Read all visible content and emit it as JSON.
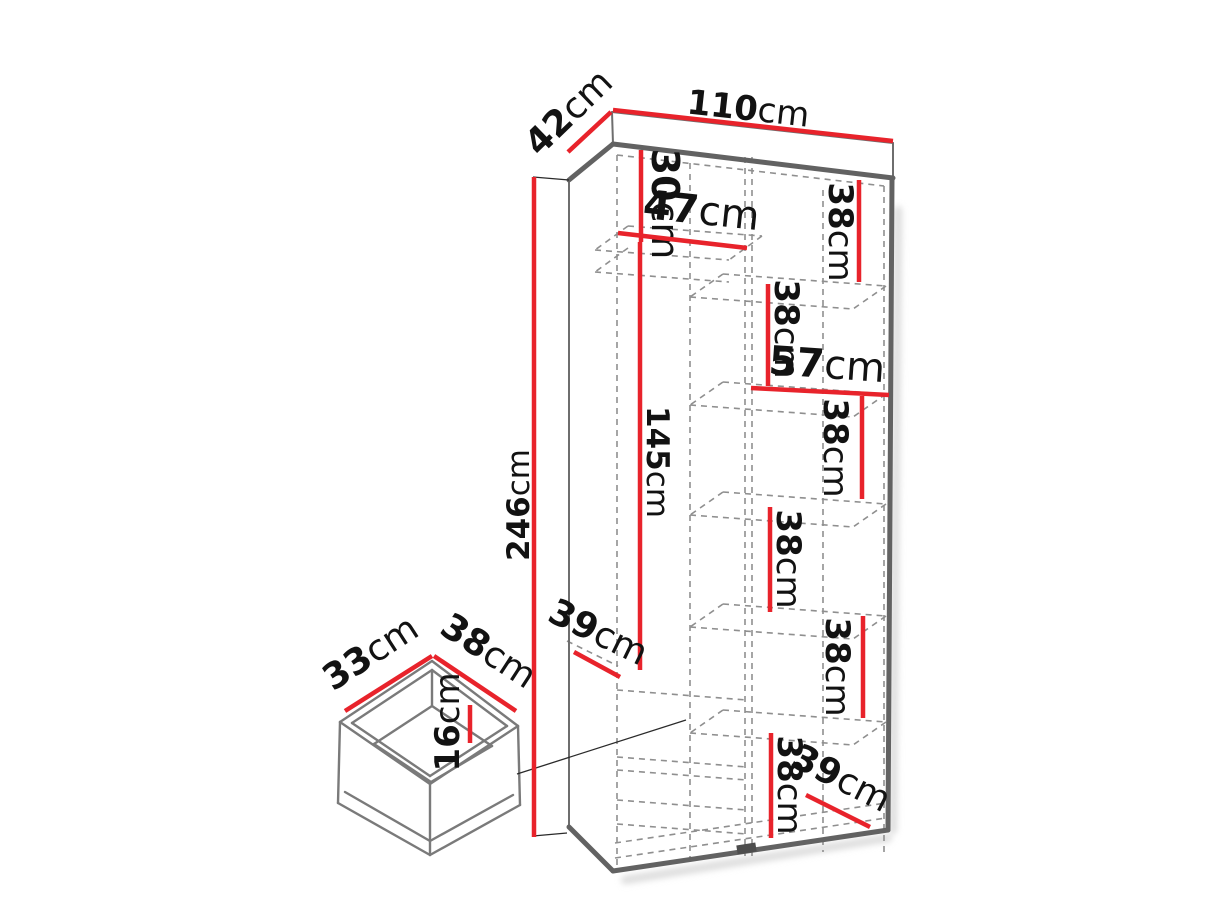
{
  "diagram_title": "Wardrobe dimension diagram",
  "units": "cm",
  "colors": {
    "dimension_line": "#e8232b",
    "outline": "#626262",
    "hidden_line": "#8f8f8f",
    "label_text": "#121212",
    "background": "#ffffff"
  },
  "wardrobe": {
    "overall": {
      "width": "110",
      "depth": "42",
      "height": "246"
    },
    "dimensions": [
      {
        "id": "overall-width",
        "value": "110",
        "unit": "cm",
        "line": [
          613,
          110,
          893,
          141
        ],
        "label": {
          "x": 747,
          "y": 120,
          "rot": 6.3,
          "size": 34
        }
      },
      {
        "id": "overall-depth",
        "value": "42",
        "unit": "cm",
        "line": [
          568,
          152,
          611,
          112
        ],
        "label": {
          "x": 577,
          "y": 121,
          "rot": -44,
          "size": 36
        }
      },
      {
        "id": "overall-height",
        "value": "246",
        "unit": "cm",
        "line": [
          534,
          177,
          534,
          837
        ],
        "label": {
          "x": 529,
          "y": 505,
          "rot": -90,
          "size": 31
        }
      },
      {
        "id": "top-shelf-height",
        "value": "30",
        "unit": "cm",
        "line": [
          641,
          150,
          641,
          242
        ],
        "label": {
          "x": 652,
          "y": 204,
          "rot": 90,
          "size": 38
        }
      },
      {
        "id": "left-section-width",
        "value": "47",
        "unit": "cm",
        "line": [
          618,
          233,
          747,
          248
        ],
        "label": {
          "x": 700,
          "y": 224,
          "rot": 6,
          "size": 40
        }
      },
      {
        "id": "hanging-height",
        "value": "145",
        "unit": "cm",
        "line": [
          640,
          242,
          640,
          670
        ],
        "label": {
          "x": 647,
          "y": 462,
          "rot": 90,
          "size": 31
        }
      },
      {
        "id": "left-shelf-depth",
        "value": "39",
        "unit": "cm",
        "line": [
          574,
          652,
          620,
          677
        ],
        "label": {
          "x": 593,
          "y": 643,
          "rot": 26,
          "size": 36
        }
      },
      {
        "id": "right-shelf-1",
        "value": "38",
        "unit": "cm",
        "line": [
          859,
          180,
          859,
          282
        ],
        "label": {
          "x": 829,
          "y": 232,
          "rot": 90,
          "size": 34
        }
      },
      {
        "id": "right-shelf-2",
        "value": "38",
        "unit": "cm",
        "line": [
          768,
          284,
          768,
          386
        ],
        "label": {
          "x": 775,
          "y": 329,
          "rot": 90,
          "size": 34
        }
      },
      {
        "id": "right-section-width",
        "value": "57",
        "unit": "cm",
        "line": [
          751,
          388,
          889,
          395
        ],
        "label": {
          "x": 826,
          "y": 378,
          "rot": 4,
          "size": 40
        }
      },
      {
        "id": "right-shelf-3",
        "value": "38",
        "unit": "cm",
        "line": [
          862,
          396,
          862,
          499
        ],
        "label": {
          "x": 824,
          "y": 448,
          "rot": 90,
          "size": 34
        }
      },
      {
        "id": "right-shelf-4",
        "value": "38",
        "unit": "cm",
        "line": [
          770,
          507,
          770,
          612
        ],
        "label": {
          "x": 777,
          "y": 559,
          "rot": 90,
          "size": 34
        }
      },
      {
        "id": "right-shelf-5",
        "value": "38",
        "unit": "cm",
        "line": [
          863,
          616,
          863,
          718
        ],
        "label": {
          "x": 826,
          "y": 667,
          "rot": 90,
          "size": 34
        }
      },
      {
        "id": "right-shelf-6",
        "value": "38",
        "unit": "cm",
        "line": [
          771,
          733,
          771,
          838
        ],
        "label": {
          "x": 778,
          "y": 785,
          "rot": 90,
          "size": 34
        }
      },
      {
        "id": "bottom-shelf-depth",
        "value": "39",
        "unit": "cm",
        "line": [
          806,
          795,
          870,
          827
        ],
        "label": {
          "x": 836,
          "y": 789,
          "rot": 27,
          "size": 36
        }
      }
    ]
  },
  "drawer": {
    "dimensions": [
      {
        "id": "drawer-width",
        "value": "33",
        "unit": "cm",
        "line": [
          345,
          711,
          432,
          656
        ],
        "label": {
          "x": 377,
          "y": 663,
          "rot": -33,
          "size": 36
        }
      },
      {
        "id": "drawer-depth",
        "value": "38",
        "unit": "cm",
        "line": [
          434,
          656,
          516,
          711
        ],
        "label": {
          "x": 482,
          "y": 661,
          "rot": 33,
          "size": 36
        }
      },
      {
        "id": "drawer-height",
        "value": "16",
        "unit": "cm",
        "line": [
          470,
          705,
          470,
          743
        ],
        "label": {
          "x": 459,
          "y": 722,
          "rot": -90,
          "size": 34
        }
      }
    ]
  }
}
